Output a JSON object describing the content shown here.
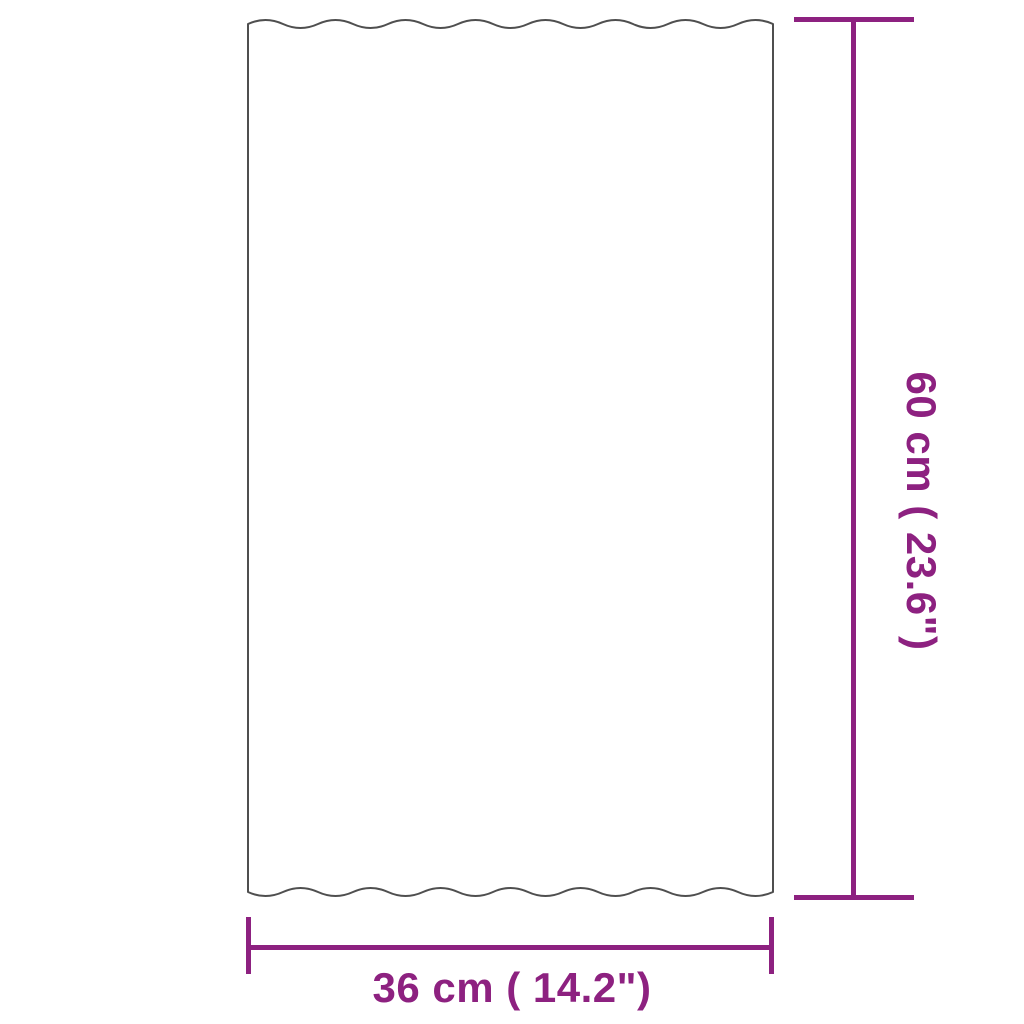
{
  "diagram": {
    "type": "product-dimension-diagram",
    "object": "corrugated-sheet",
    "colors": {
      "dimension_accent": "#8d2180",
      "outline": "#4f4f4f",
      "background": "#ffffff"
    },
    "dimensions": {
      "vertical": {
        "label": "60 cm ( 23.6\")",
        "value_cm": 60,
        "value_in": 23.6
      },
      "horizontal": {
        "label": "36 cm ( 14.2\")",
        "value_cm": 36,
        "value_in": 14.2
      }
    }
  }
}
